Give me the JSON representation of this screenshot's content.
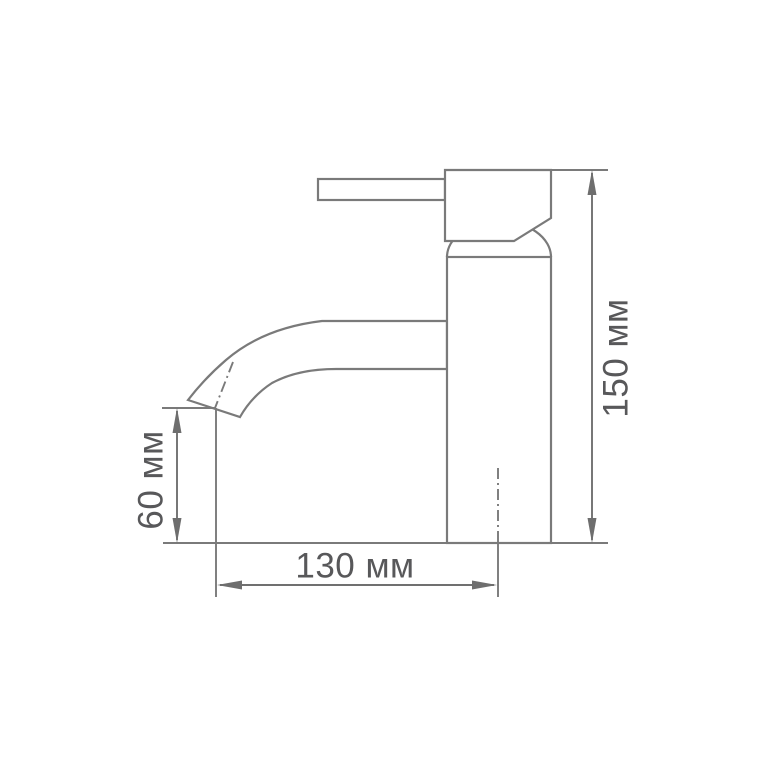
{
  "diagram": {
    "subject": "single-lever basin faucet side-view dimension drawing",
    "colors": {
      "background": "#ffffff",
      "line": "#7a7a7a",
      "dimension_line": "#707070",
      "text": "#58585a"
    },
    "dimensions": {
      "total_height": {
        "label": "150 мм",
        "value": 150,
        "unit": "мм",
        "orientation": "vertical-right"
      },
      "spout_height": {
        "label": "60 мм",
        "value": 60,
        "unit": "мм",
        "orientation": "vertical-left"
      },
      "spout_reach": {
        "label": "130 мм",
        "value": 130,
        "unit": "мм",
        "orientation": "horizontal-bottom"
      }
    }
  }
}
